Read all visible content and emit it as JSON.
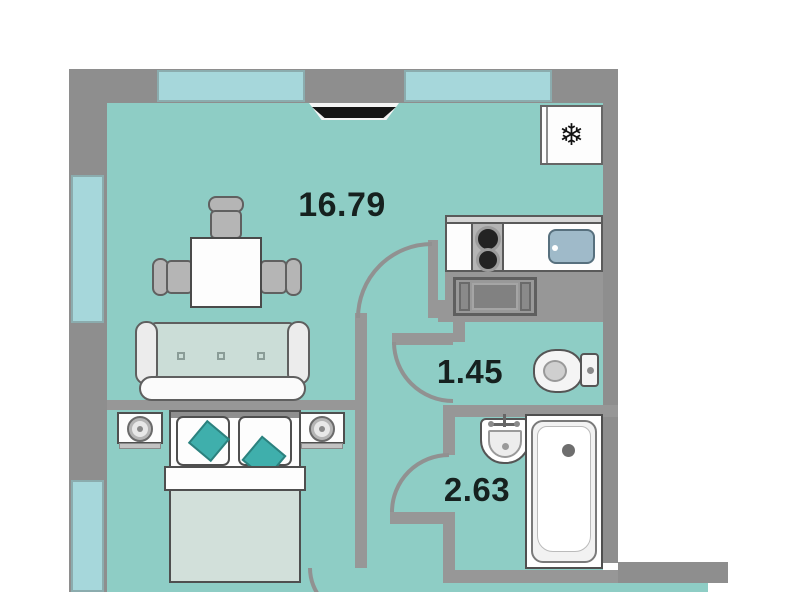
{
  "plan_title": "studio apartment floor plan",
  "rooms": [
    {
      "id": "living-kitchen",
      "area": "16.79"
    },
    {
      "id": "wc",
      "area": "1.45"
    },
    {
      "id": "bathroom",
      "area": "2.63"
    }
  ],
  "icons": {
    "fridge_snowflake": "❄"
  },
  "colors": {
    "floor_teal": "#8ecdc5",
    "wall_gray": "#8e8e8e",
    "window_blue": "#a6d7db",
    "accent_teal": "#3fafac",
    "furniture_outline": "#4f4f4f",
    "label_text": "#16211f",
    "sink_blue": "#9fbac9"
  }
}
